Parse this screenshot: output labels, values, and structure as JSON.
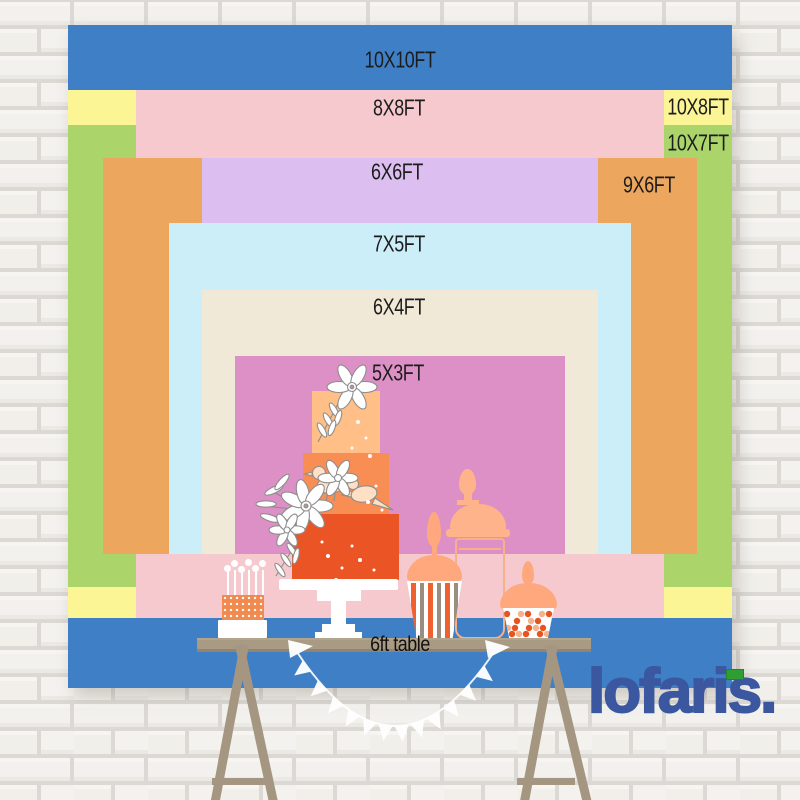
{
  "brand": {
    "name": "lofaris",
    "dot": ".",
    "logo_color": "#3a57a0",
    "accent_color": "#2f9e33"
  },
  "table": {
    "label": "6ft table",
    "color": "#a89a83"
  },
  "sizes": [
    {
      "id": "10x10",
      "label": "10X10FT",
      "width_ft": 10,
      "height_ft": 10,
      "color": "#3f7fc5"
    },
    {
      "id": "10x8",
      "label": "10X8FT",
      "width_ft": 10,
      "height_ft": 8,
      "color": "#fbf595"
    },
    {
      "id": "10x7",
      "label": "10X7FT",
      "width_ft": 10,
      "height_ft": 7,
      "color": "#abd56b"
    },
    {
      "id": "8x8",
      "label": "8X8FT",
      "width_ft": 8,
      "height_ft": 8,
      "color": "#f6c9ce"
    },
    {
      "id": "9x6",
      "label": "9X6FT",
      "width_ft": 9,
      "height_ft": 6,
      "color": "#eca65e"
    },
    {
      "id": "6x6",
      "label": "6X6FT",
      "width_ft": 6,
      "height_ft": 6,
      "color": "#ddbef1"
    },
    {
      "id": "7x5",
      "label": "7X5FT",
      "width_ft": 7,
      "height_ft": 5,
      "color": "#cbeef9"
    },
    {
      "id": "6x4",
      "label": "6X4FT",
      "width_ft": 6,
      "height_ft": 4,
      "color": "#f1e9d8"
    },
    {
      "id": "5x3",
      "label": "5X3FT",
      "width_ft": 5,
      "height_ft": 3,
      "color": "#dd90c5"
    }
  ],
  "scene": {
    "wall": "white painted brick wall",
    "table_color": "#a89a83",
    "cake_tier_colors": [
      "#ffbf87",
      "#f98e55",
      "#eb5526"
    ],
    "jar_lid_color": "#ffa87d"
  }
}
